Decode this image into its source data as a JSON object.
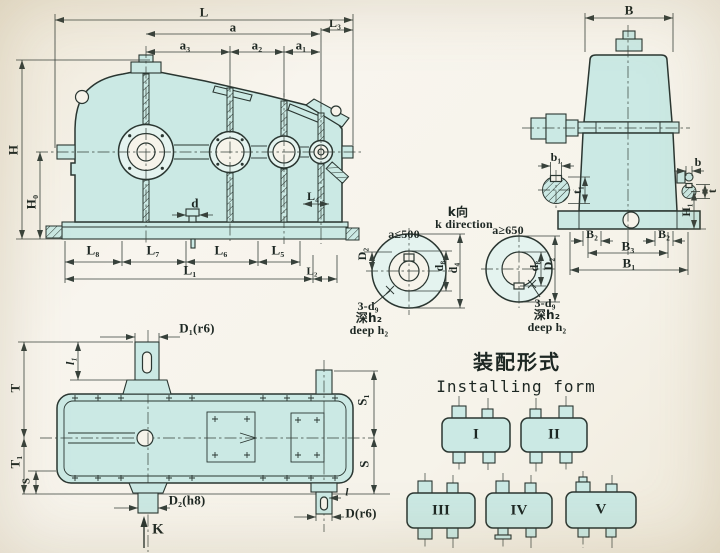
{
  "side_view": {
    "L": "L",
    "a": "a",
    "L3": "L₃",
    "a3": "a₃",
    "a2": "a₂",
    "a1": "a₁",
    "H": "H",
    "H0": "H₀",
    "d": "d",
    "L4": "L₄",
    "L8": "L₈",
    "L7": "L₇",
    "L6": "L₆",
    "L5": "L₅",
    "L1": "L₁",
    "L2": "L₂"
  },
  "end_view": {
    "B": "B",
    "b1": "b₁",
    "t1": "t₁",
    "b": "b",
    "t": "t",
    "H1": "H₁",
    "B2_left": "B₂",
    "B2_right": "B₂",
    "B3": "B₃",
    "B1": "B₁"
  },
  "k_view": {
    "title_cn": "k向",
    "title_en": "k direction",
    "left": {
      "condition": "a≤500",
      "D2": "D₂",
      "d8": "d₈",
      "d4": "d₄",
      "holes": "3-d₉",
      "depth_cn": "深h₂",
      "depth_en": "deep h₂"
    },
    "right": {
      "condition": "a≥650",
      "d8": "d₈",
      "D2": "D₂",
      "holes": "3-d₉",
      "depth_cn": "深h₂",
      "depth_en": "deep h₂"
    }
  },
  "top_view": {
    "D1": "D₁(r6)",
    "l1": "l₁",
    "T": "T",
    "T1": "T₁",
    "S_left": "S",
    "S1": "S₁",
    "S_right": "S",
    "D2h8": "D₂(h8)",
    "l": "l",
    "Dr6": "D(r6)",
    "K": "K"
  },
  "installing": {
    "title_cn": "装配形式",
    "title_en": "Installing form",
    "forms": [
      "I",
      "II",
      "III",
      "IV",
      "V"
    ]
  }
}
